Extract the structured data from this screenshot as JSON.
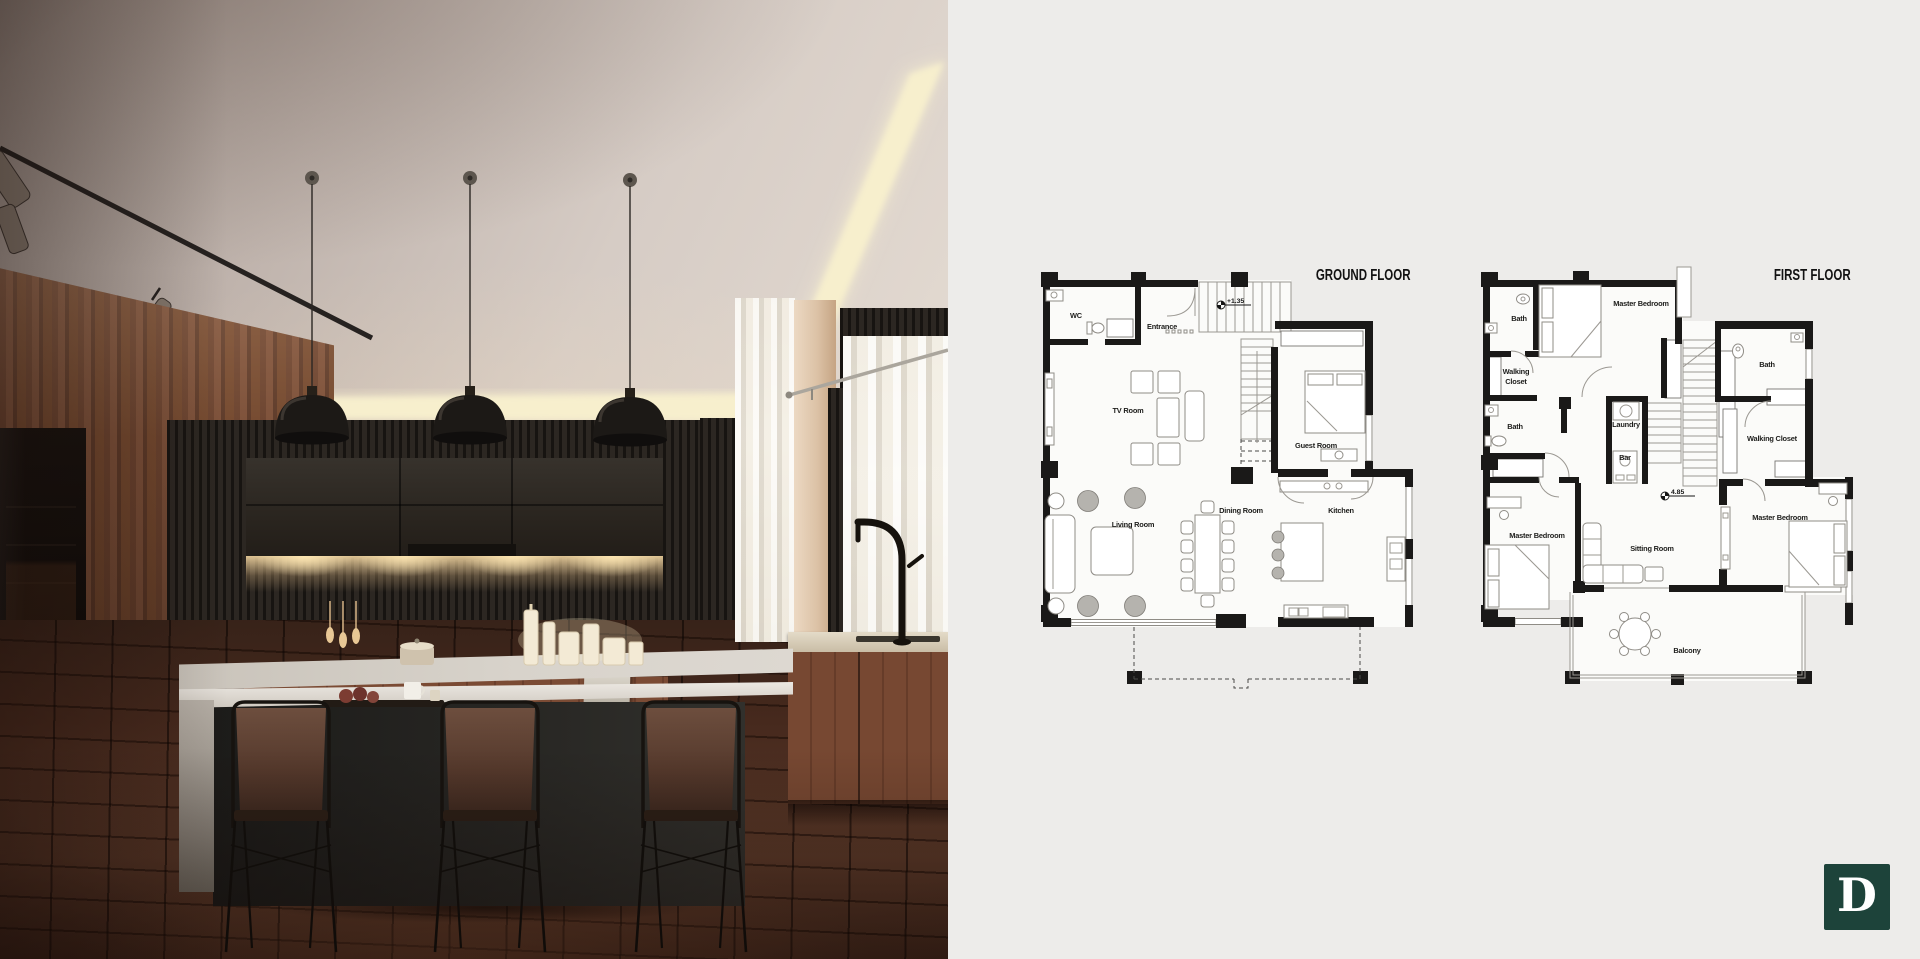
{
  "panel": {
    "bg": "#edecea"
  },
  "plans": [
    {
      "id": "ground",
      "title": "GROUND FLOOR",
      "marker": {
        "text": "+1.35",
        "x": 186,
        "y": 50
      },
      "labels": [
        {
          "text": "WC",
          "x": 41,
          "y": 63
        },
        {
          "text": "Entrance",
          "x": 127,
          "y": 74
        },
        {
          "text": "TV Room",
          "x": 93,
          "y": 158
        },
        {
          "text": "Guest Room",
          "x": 281,
          "y": 193
        },
        {
          "text": "Living Room",
          "x": 98,
          "y": 272
        },
        {
          "text": "Dining Room",
          "x": 206,
          "y": 258
        },
        {
          "text": "Kitchen",
          "x": 306,
          "y": 258
        }
      ]
    },
    {
      "id": "first",
      "title": "FIRST FLOOR",
      "marker": {
        "text": "4.85",
        "x": 190,
        "y": 241
      },
      "labels": [
        {
          "text": "Bath",
          "x": 44,
          "y": 66
        },
        {
          "text": "Master Bedroom",
          "x": 166,
          "y": 51
        },
        {
          "text": "Walking",
          "x": 41,
          "y": 119
        },
        {
          "text": "Closet",
          "x": 41,
          "y": 129
        },
        {
          "text": "Bath",
          "x": 40,
          "y": 174
        },
        {
          "text": "Laundry",
          "x": 151,
          "y": 172
        },
        {
          "text": "Bar",
          "x": 150,
          "y": 205
        },
        {
          "text": "Bath",
          "x": 292,
          "y": 112
        },
        {
          "text": "Walking Closet",
          "x": 297,
          "y": 186
        },
        {
          "text": "Master Bedroom",
          "x": 62,
          "y": 283
        },
        {
          "text": "Sitting Room",
          "x": 177,
          "y": 296
        },
        {
          "text": "Master Bedroom",
          "x": 305,
          "y": 265
        },
        {
          "text": "Balcony",
          "x": 212,
          "y": 398
        }
      ]
    }
  ],
  "logo": {
    "letter": "D",
    "bg": "#1d433a",
    "fg": "#ffffff"
  }
}
